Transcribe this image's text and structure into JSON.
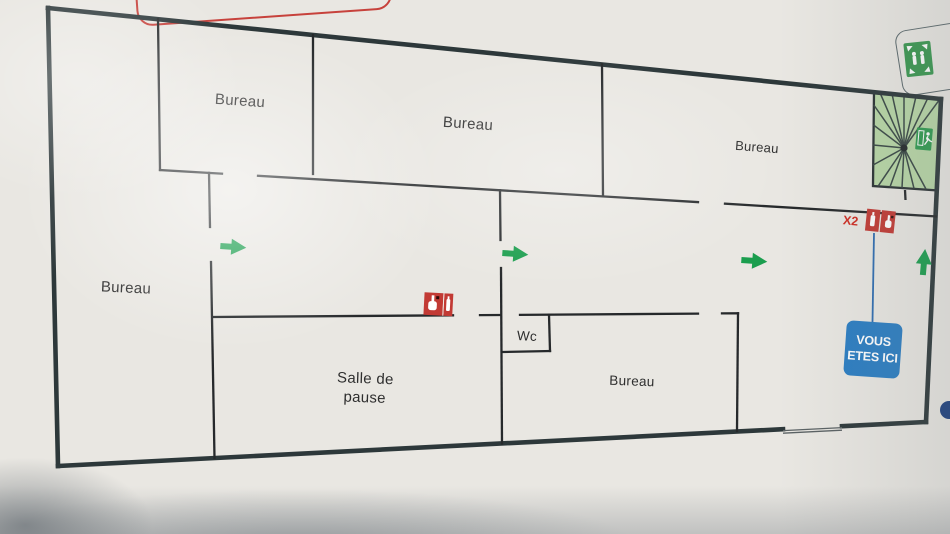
{
  "rooms": {
    "bureau_top_left": "Bureau",
    "bureau_top_middle": "Bureau",
    "bureau_top_right": "Bureau",
    "bureau_left": "Bureau",
    "bureau_bottom": "Bureau",
    "break_room_line1": "Salle de",
    "break_room_line2": "pause",
    "toilet": "Wc"
  },
  "markers": {
    "you_are_here_line1": "VOUS",
    "you_are_here_line2": "ETES ICI",
    "extinguisher_count": "X2"
  },
  "icons": {
    "staircase": "stairs-icon",
    "emergency_exit": "emergency-exit-icon",
    "assembly_point": "assembly-point-icon",
    "fire_extinguisher": "fire-extinguisher-icon",
    "manual_call_point": "manual-call-point-icon",
    "evacuation_arrow": "evacuation-arrow-icon",
    "you_are_here": "you-are-here-badge"
  },
  "colors": {
    "outer_wall": "#2d383a",
    "interior_wall": "#26292b",
    "arrow_green": "#1b9e4e",
    "stair_fill": "#b8d7a6",
    "safety_red": "#c23a34",
    "marker_blue": "#2b7dc2",
    "title_red": "#c7423c"
  }
}
